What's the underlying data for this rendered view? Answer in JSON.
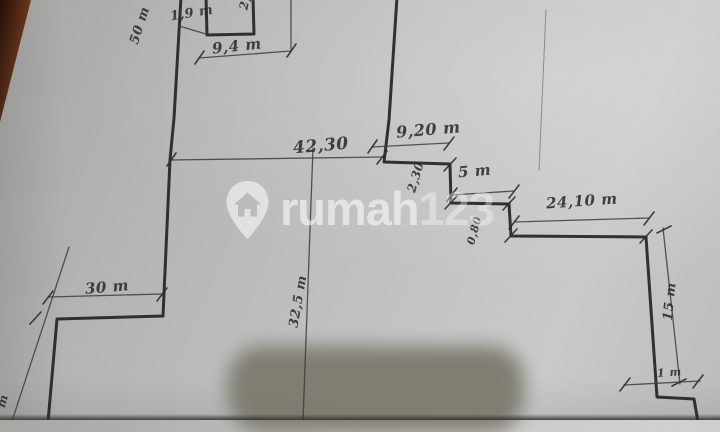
{
  "scene": "hand-drawn land plot survey sketch, photographed on paper",
  "colors": {
    "paper": "#c0c2c1",
    "ink": "#242424",
    "table_wood": "#6b3a1c",
    "redaction": "#7d7a6f",
    "watermark": "#ffffff"
  },
  "watermark": {
    "brand_prefix": "rumah",
    "brand_suffix": "123",
    "icon": "map-pin-house-icon"
  },
  "labels": {
    "d19": "1,9 m",
    "d2top": "2,",
    "d50": "50 m",
    "d94": "9,4 m",
    "d4230": "42,30",
    "d920": "9,20 m",
    "d230": "2,30",
    "d5": "5 m",
    "d080": "0,80",
    "d2410": "24,10 m",
    "d15": "15 m",
    "d325": "32,5 m",
    "d30": "30 m",
    "d1": "1 m",
    "dm": "m"
  }
}
